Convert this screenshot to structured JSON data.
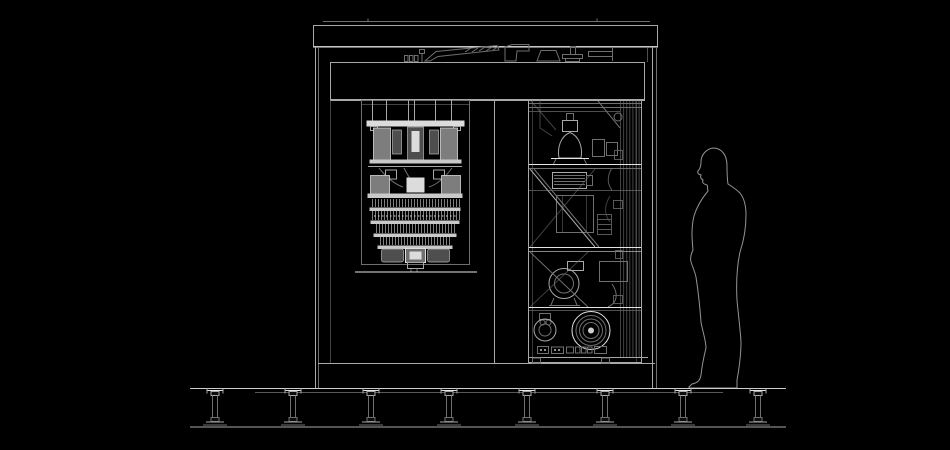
{
  "scene": {
    "label": "technical-elevation-drawing-quantum-computer-system",
    "background_color": "#000000",
    "colors": {
      "line": "#a8a8a8",
      "bright_line": "#e4e4e4",
      "dim_line": "#6f6f6f",
      "silhouette_line": "#949494",
      "plate_fill": "#dcdcdc",
      "cylinder_fill": "#7d7d7d"
    },
    "components": {
      "roof": "roof-slab",
      "rooftop": "rooftop-ducting",
      "header": "front-header-panel",
      "left_bay": "cryostat-chandelier",
      "right_bay": "equipment-rack",
      "rack_items": [
        "dome-pump",
        "finned-compressor",
        "mid-pump",
        "small-pump",
        "large-turbo-pump",
        "connector-row",
        "pipe-bundle"
      ],
      "figure": "human-silhouette-for-scale",
      "floor": "raised-access-floor"
    },
    "floor": {
      "pedestal_count": 8
    }
  }
}
